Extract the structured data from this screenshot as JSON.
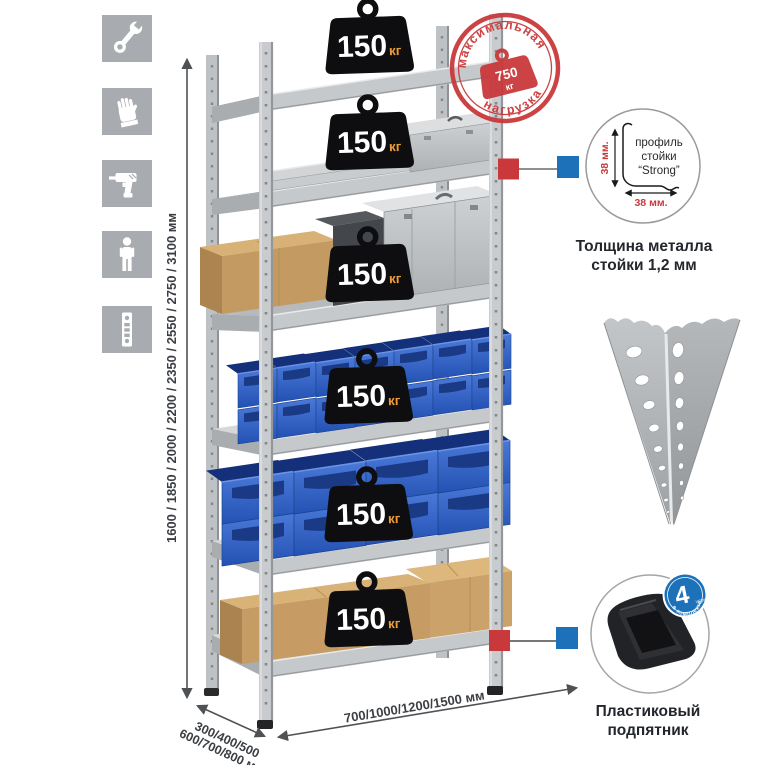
{
  "colors": {
    "accent_red": "#c9393b",
    "callout_blue": "#1d71b8",
    "bin_blue": "#2e62c6",
    "metal_gray": "#c6c9cc",
    "icon_gray": "#a8acb0",
    "weight_black": "#0e0e10",
    "kg_orange": "#ef9b3a"
  },
  "side_icons": [
    {
      "name": "wrench-icon"
    },
    {
      "name": "gloves-icon"
    },
    {
      "name": "drill-icon"
    },
    {
      "name": "person-icon"
    },
    {
      "name": "rack-post-icon"
    }
  ],
  "dimensions": {
    "height": "1600 / 1850 / 2000 / 2200 / 2350 / 2550 / 2750 / 3100 мм",
    "depth_line1": "300/400/500",
    "depth_line2": "600/700/800 мм",
    "width": "700/1000/1200/1500 мм"
  },
  "shelf_loads": [
    {
      "value": "150",
      "unit": "кг"
    },
    {
      "value": "150",
      "unit": "кг"
    },
    {
      "value": "150",
      "unit": "кг"
    },
    {
      "value": "150",
      "unit": "кг"
    },
    {
      "value": "150",
      "unit": "кг"
    },
    {
      "value": "150",
      "unit": "кг"
    }
  ],
  "max_load_stamp": {
    "arc_top": "максимальная",
    "arc_bottom": "нагрузка",
    "value": "750",
    "unit": "кг"
  },
  "profile_callout": {
    "text_line1": "профиль",
    "text_line2": "стойки",
    "text_line3": "“Strong”",
    "dim_vertical": "38 мм.",
    "dim_horizontal": "38 мм.",
    "caption_line1": "Толщина металла",
    "caption_line2": "стойки 1,2 мм"
  },
  "foot_callout": {
    "badge_number": "4",
    "badge_word": "штуки",
    "badge_arc": "в комплекте",
    "caption_line1": "Пластиковый",
    "caption_line2": "подпятник"
  }
}
